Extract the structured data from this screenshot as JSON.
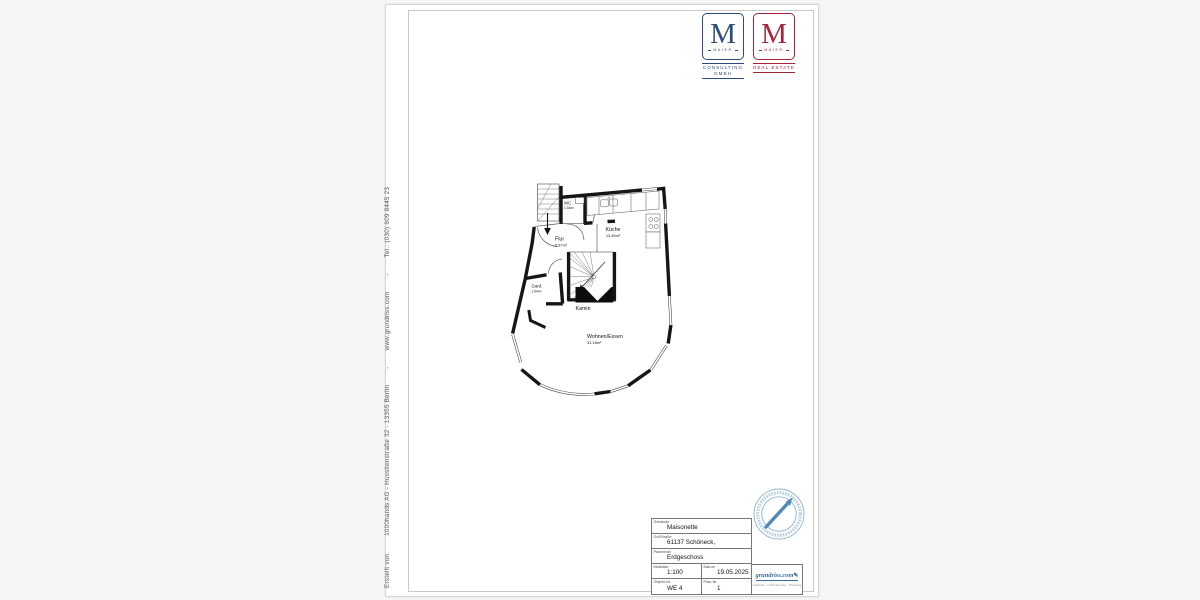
{
  "sidebar": {
    "credit_text": "Erstellt von:        1000hands AG - Hussitenstraße 32 - 13355 Berlin        -        www.grundriss.com        -        Tel.: (030) 609 8445 23"
  },
  "logos": {
    "consulting": {
      "monogram": "M",
      "name": "MAIER",
      "tagline_line1": "CONSULTING",
      "tagline_line2": "GMBH",
      "color": "#2c4c7c"
    },
    "real_estate": {
      "monogram": "M",
      "name": "MAIER",
      "tagline_line1": "REAL ESTATE",
      "color": "#a32638"
    }
  },
  "floorplan": {
    "rooms": {
      "wc": {
        "name": "WC",
        "area": "1.34m²"
      },
      "kueche": {
        "name": "Küche",
        "area": "13.49m²"
      },
      "flur": {
        "name": "Flur",
        "area": "5.87m²"
      },
      "gard": {
        "name": "Gard.",
        "area": "1.94m²"
      },
      "kamin": {
        "name": "Kamin"
      },
      "wohnen": {
        "name": "Wohnen/Essen",
        "area": "31.18m²"
      }
    }
  },
  "titleblock": {
    "fields": {
      "gebaeude": {
        "label": "Gebäude",
        "value": "Maisonette"
      },
      "ort": {
        "label": "Ort/Straße",
        "value": "61137 Schöneck,"
      },
      "planinhalt": {
        "label": "Planinhalt",
        "value": "Erdgeschoss"
      },
      "massstab": {
        "label": "Maßstab",
        "value": "1:100"
      },
      "datum": {
        "label": "Datum",
        "value": "19.05.2025"
      },
      "objekt": {
        "label": "Objekt-Nr.",
        "value": "WE 4"
      },
      "plan": {
        "label": "Plan-Nr.",
        "value": "1"
      }
    },
    "brand": {
      "text": "grundriss.com",
      "tagline": "Aufmaß - CAD-Service - Planung",
      "color": "#39699f"
    },
    "stamp_color": "#8ab4d2"
  }
}
